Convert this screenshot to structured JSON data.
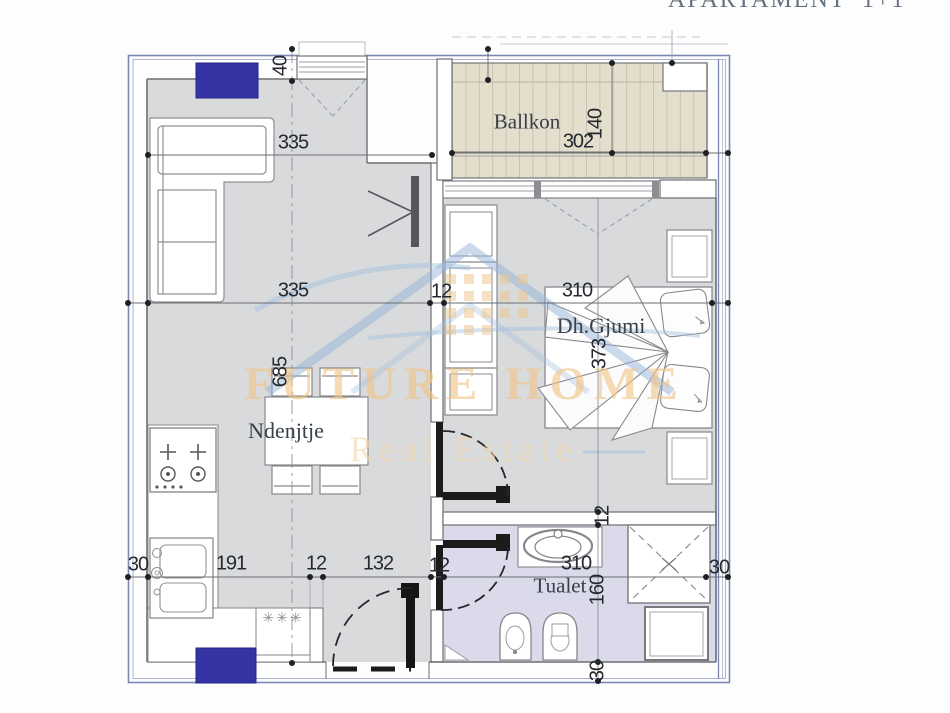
{
  "title": "APARTAMENT  1+1",
  "watermark": {
    "brand": "FUTURE HOME",
    "tagline": "Real Estate"
  },
  "rooms": {
    "balcony": "Ballkon",
    "bedroom": "Dh.Gjumi",
    "living": "Ndenjtje",
    "toilet": "Tualet"
  },
  "dims": {
    "d40": "40",
    "d335_upper": "335",
    "d302": "302",
    "d140": "140",
    "d335": "335",
    "d12_wall": "12",
    "d310_bed": "310",
    "d373": "373",
    "d685": "685",
    "d30_left": "30",
    "d191": "191",
    "d12_counter": "12",
    "d132": "132",
    "d12_hall": "12",
    "d310_toilet": "310",
    "d160": "160",
    "d12_toilet_wall": "12",
    "d30_right": "30",
    "d30_bottom": "30"
  },
  "symbols": {
    "appliance": "✳✳✳"
  },
  "colors": {
    "column_blue": "#3434a4",
    "floor_gray": "#d9dadc",
    "balcony_floor": "#e4decd",
    "toilet_floor": "#dadaea",
    "frame_blue": "#7e86b4"
  }
}
